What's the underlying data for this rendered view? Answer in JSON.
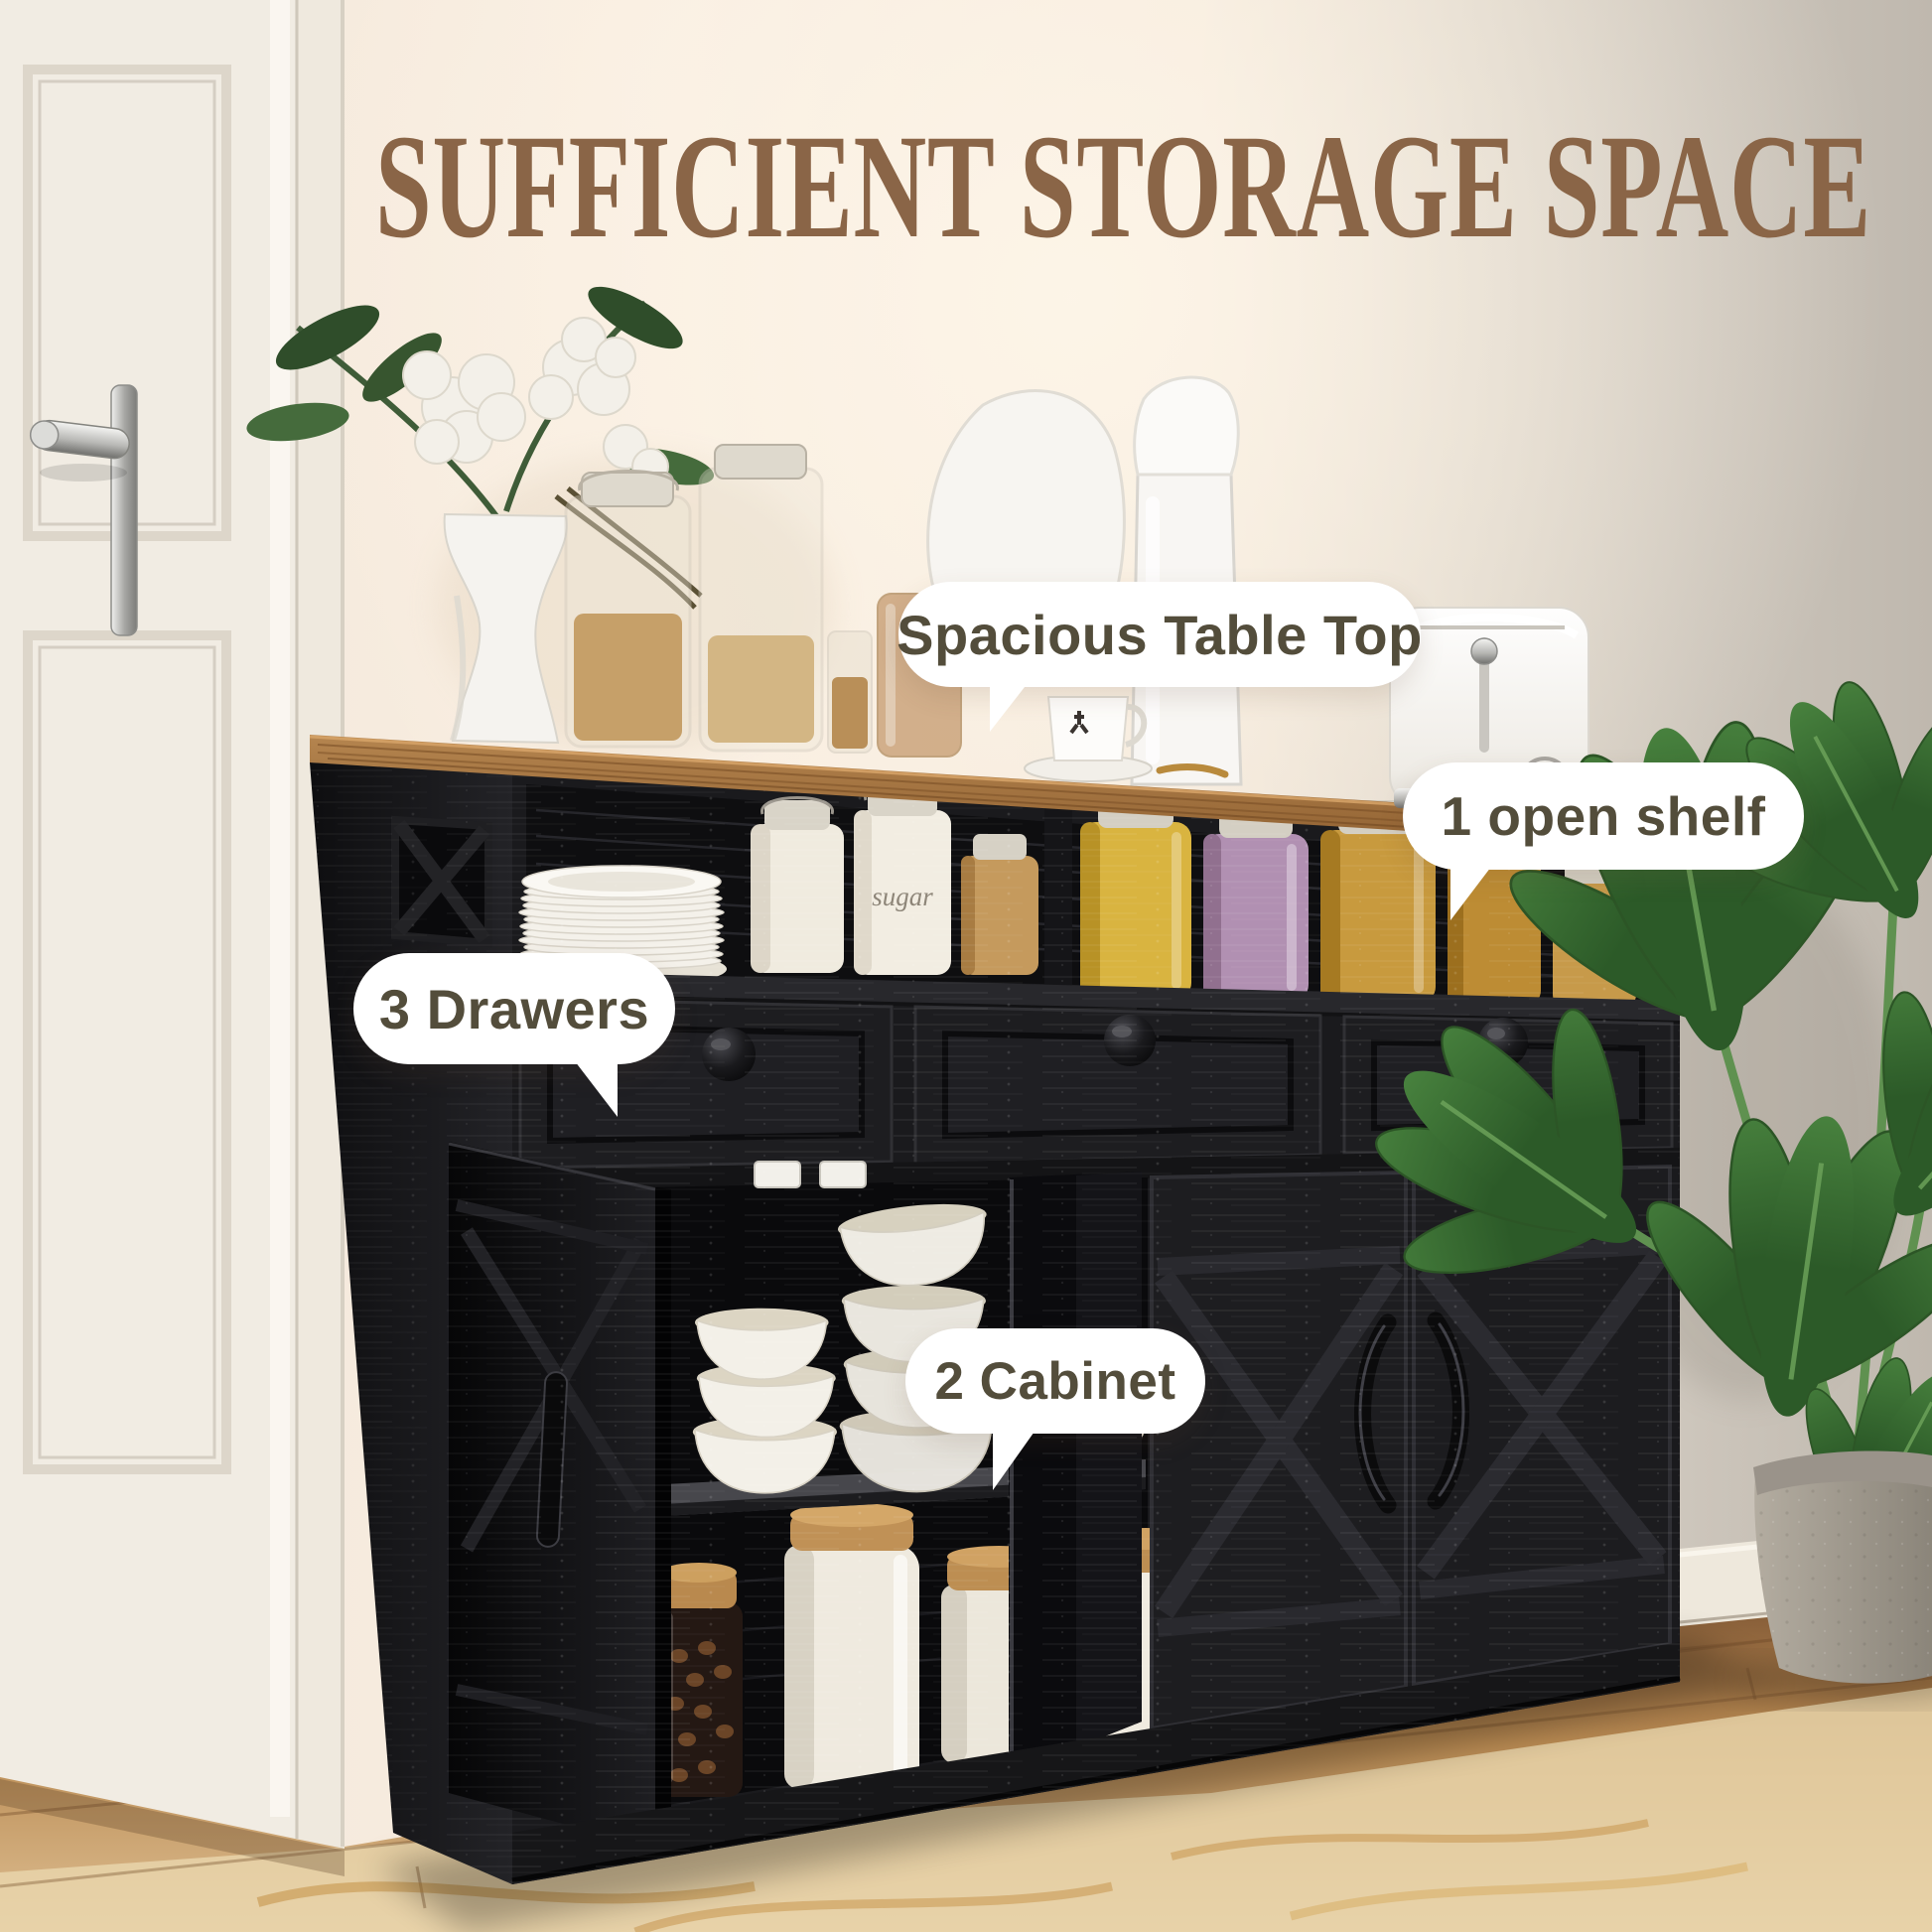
{
  "title": {
    "text": "SUFFICIENT STORAGE SPACE"
  },
  "callouts": {
    "table_top": {
      "label": "Spacious Table Top"
    },
    "open_shelf": {
      "label": "1 open shelf"
    },
    "drawers": {
      "label": "3 Drawers"
    },
    "cabinet": {
      "label": "2 Cabinet"
    }
  },
  "scene": {
    "toaster": {
      "dial_label": "STOP"
    },
    "shelf": {
      "sugar_jar_label": "sugar"
    }
  },
  "colors": {
    "title": "#8a6547",
    "bubble_bg": "#ffffff",
    "bubble_text": "#534d3b",
    "door_white": "#f1ece3",
    "cabinet_black": "#1a1a1d"
  }
}
